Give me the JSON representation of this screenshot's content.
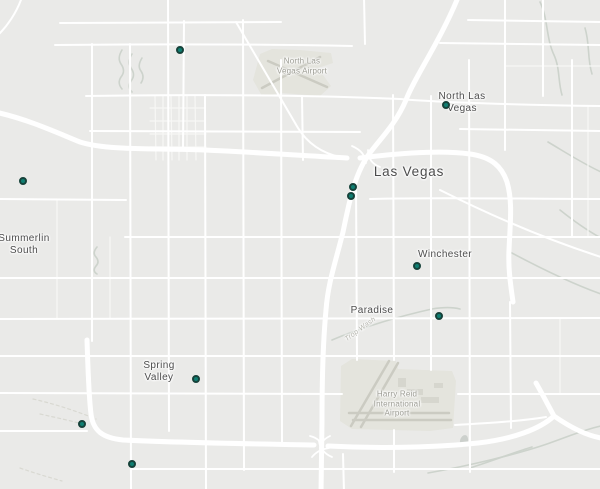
{
  "map": {
    "colors": {
      "background": "#eaeae8",
      "road": "#ffffff",
      "road_minor": "#f7f7f5",
      "airport_fill": "#e4e4dd",
      "runway": "#cbcbc2",
      "wash": "#cdd3cc",
      "marker_fill": "#0f7e71",
      "marker_border": "#16423a",
      "city_label": "#4c4c4c",
      "area_label": "#9b9b92",
      "wash_label": "#b3b3ab"
    },
    "labels": [
      {
        "id": "north-las-vegas-airport",
        "text": "North Las\nVegas Airport",
        "x": 302,
        "y": 66,
        "type": "poi"
      },
      {
        "id": "north-las-vegas",
        "text": "North Las\nVegas",
        "x": 462,
        "y": 103,
        "type": "city"
      },
      {
        "id": "las-vegas",
        "text": "Las Vegas",
        "x": 409,
        "y": 172,
        "type": "city-major"
      },
      {
        "id": "summerlin-south",
        "text": "Summerlin\nSouth",
        "x": 24,
        "y": 245,
        "type": "city"
      },
      {
        "id": "winchester",
        "text": "Winchester",
        "x": 445,
        "y": 255,
        "type": "city"
      },
      {
        "id": "paradise",
        "text": "Paradise",
        "x": 372,
        "y": 311,
        "type": "city"
      },
      {
        "id": "spring-valley",
        "text": "Spring\nValley",
        "x": 159,
        "y": 372,
        "type": "city"
      },
      {
        "id": "harry-reid-international-airport",
        "text": "Harry Reid\nInternational\nAirport",
        "x": 397,
        "y": 404,
        "type": "poi"
      },
      {
        "id": "trop-wash",
        "text": "Trop Wash",
        "x": 361,
        "y": 330,
        "type": "washlbl",
        "rotation": -36
      }
    ],
    "markers": [
      {
        "x": 180,
        "y": 50
      },
      {
        "x": 446,
        "y": 105
      },
      {
        "x": 23,
        "y": 181
      },
      {
        "x": 353,
        "y": 187
      },
      {
        "x": 351,
        "y": 196
      },
      {
        "x": 417,
        "y": 266
      },
      {
        "x": 439,
        "y": 316
      },
      {
        "x": 196,
        "y": 379
      },
      {
        "x": 82,
        "y": 424
      },
      {
        "x": 132,
        "y": 464
      }
    ]
  }
}
